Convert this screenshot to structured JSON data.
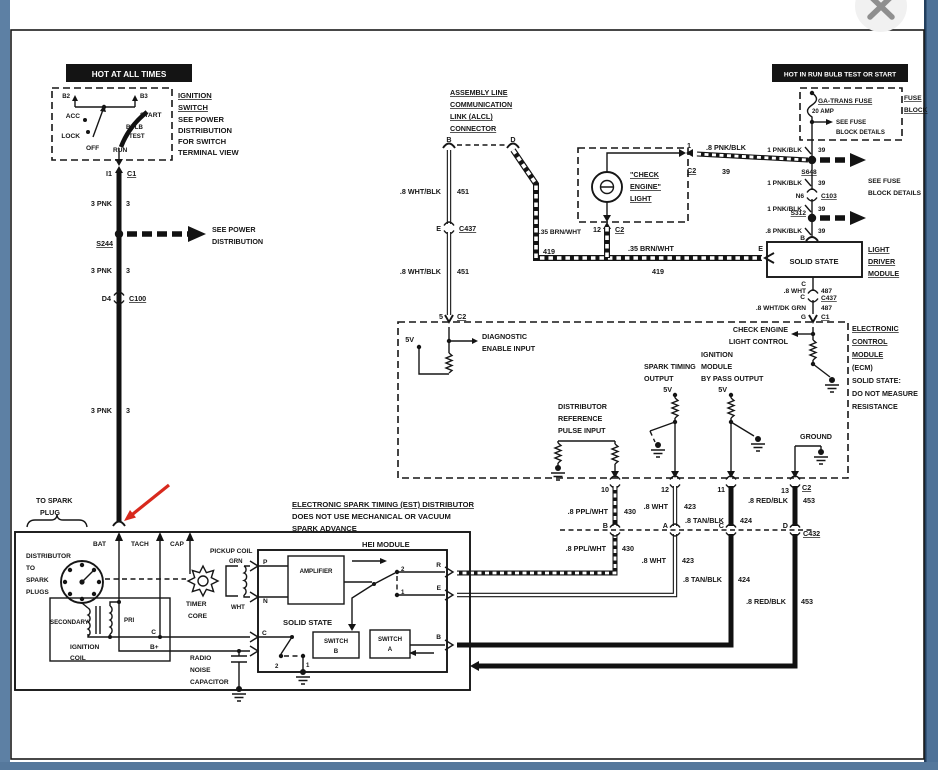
{
  "window": {
    "close": "×"
  },
  "colors": {
    "border_left": "#5d80a4",
    "border_right": "#4e7298",
    "border_bottom": "#55789c",
    "frame": "#1a1a1a",
    "red_arrow": "#d8291d",
    "banner_bg": "#0a0a0a"
  },
  "ign": {
    "banner": "HOT AT ALL TIMES",
    "b2": "B2",
    "b3": "B3",
    "acc": "ACC",
    "lock": "LOCK",
    "off": "OFF",
    "run": "RUN",
    "start": "START",
    "bulb": "BULB",
    "test": "TEST",
    "t1": "IGNITION",
    "t2": "SWITCH",
    "n1": "SEE POWER",
    "n2": "DISTRIBUTION",
    "n3": "FOR SWITCH",
    "n4": "TERMINAL VIEW",
    "i1": "I1",
    "c1": "C1",
    "pnk": "3 PNK",
    "three": "3",
    "s244": "S244",
    "sp1": "SEE POWER",
    "sp2": "DISTRIBUTION",
    "d4": "D4",
    "c100": "C100"
  },
  "alcl": {
    "t1": "ASSEMBLY LINE",
    "t2": "COMMUNICATION",
    "t3": "LINK (ALCL)",
    "t4": "CONNECTOR",
    "b": "B",
    "d": "D",
    "w1": ".8 WHT/BLK",
    "n1": "451",
    "e": "E",
    "c437": "C437",
    "w2": ".8 WHT/BLK",
    "n2": "451",
    "five": "5",
    "c2": "C2"
  },
  "cel": {
    "t1": "\"CHECK",
    "t2": "ENGINE\"",
    "t3": "LIGHT",
    "one": "1",
    "c2a": "C2",
    "w1": ".8 PNK/BLK",
    "n39": "39",
    "brn1": ".35 BRN/WHT",
    "twelve": "12",
    "c2b": "C2",
    "n419a": "419",
    "brn2": ".35 BRN/WHT",
    "n419b": "419"
  },
  "fuse": {
    "banner": "HOT IN RUN BULB TEST OR START",
    "name": "GA-TRANS FUSE",
    "amp": "20 AMP",
    "sf1": "SEE FUSE",
    "sf2": "BLOCK DETAILS",
    "fb1": "FUSE",
    "fb2": "BLOCK",
    "w1": "1 PNK/BLK",
    "n1": "39",
    "s648": "S648",
    "w2": "1 PNK/BLK",
    "n2": "39",
    "n6": "N6",
    "c103": "C103",
    "w3": "1 PNK/BLK",
    "n3": "39",
    "s312": "S312",
    "sf3": "SEE FUSE",
    "sf4": "BLOCK DETAILS",
    "w4": ".8 PNK/BLK",
    "n4": "39",
    "b": "B"
  },
  "ldm": {
    "ss": "SOLID STATE",
    "t1": "LIGHT",
    "t2": "DRIVER",
    "t3": "MODULE",
    "e": "E",
    "c1l": "C",
    "w1": ".8 WHT",
    "n1": "487",
    "c2l": "C",
    "c437": "C437",
    "w2": ".8 WHT/DK GRN",
    "n2": "487",
    "g": "G",
    "c1": "C1"
  },
  "ecm": {
    "t1": "ELECTRONIC",
    "t2": "CONTROL",
    "t3": "MODULE",
    "t4": "(ECM)",
    "t5": "SOLID STATE:",
    "t6": "DO NOT MEASURE",
    "t7": "RESISTANCE",
    "v1": "5V",
    "dg1": "DIAGNOSTIC",
    "dg2": "ENABLE INPUT",
    "rf1": "DISTRIBUTOR",
    "rf2": "REFERENCE",
    "rf3": "PULSE INPUT",
    "st1": "SPARK TIMING",
    "st2": "OUTPUT",
    "v2": "5V",
    "bp1": "IGNITION",
    "bp2": "MODULE",
    "bp3": "BY PASS OUTPUT",
    "v3": "5V",
    "cl1": "CHECK ENGINE",
    "cl2": "LIGHT CONTROL",
    "gnd": "GROUND",
    "p10": "10",
    "p12": "12",
    "p11": "11",
    "p13": "13",
    "c2": "C2",
    "tb": "B",
    "ta": "A",
    "tc": "C",
    "td": "D",
    "c432": "C432",
    "w430a": ".8 PPL/WHT",
    "n430a": "430",
    "w423a": ".8 WHT",
    "n423a": "423",
    "w424a": ".8 TAN/BLK",
    "n424a": "424",
    "w453a": ".8 RED/BLK",
    "n453a": "453",
    "w430b": ".8 PPL/WHT",
    "n430b": "430",
    "w423b": ".8 WHT",
    "n423b": "423",
    "w424b": ".8 TAN/BLK",
    "n424b": "424",
    "w453b": ".8 RED/BLK",
    "n453b": "453"
  },
  "est": {
    "h1": "ELECTRONIC SPARK TIMING (EST) DISTRIBUTOR",
    "h2": "DOES NOT USE MECHANICAL OR VACUUM",
    "h3": "SPARK ADVANCE",
    "sp1": "TO SPARK",
    "sp2": "PLUG",
    "d1": "DISTRIBUTOR",
    "d2": "TO",
    "d3": "SPARK",
    "d4": "PLUGS",
    "bat": "BAT",
    "tach": "TACH",
    "cap": "CAP",
    "sec": "SECONDARY",
    "pri": "PRI",
    "ic1": "IGNITION",
    "ic2": "COIL",
    "c_coil": "C",
    "bplus": "B+",
    "rn1": "RADIO",
    "rn2": "NOISE",
    "rn3": "CAPACITOR",
    "pc": "PICKUP COIL",
    "grn": "GRN",
    "wht": "WHT",
    "tc1": "TIMER",
    "tc2": "CORE",
    "hei": "HEI MODULE",
    "p": "P",
    "n": "N",
    "amp": "AMPLIFIER",
    "ss": "SOLID STATE",
    "swb1": "SWITCH",
    "swb2": "B",
    "swa1": "SWITCH",
    "swa2": "A",
    "two": "2",
    "one": "1",
    "r": "R",
    "e": "E",
    "b": "B",
    "c_hei": "C",
    "two2": "2",
    "one2": "1"
  }
}
